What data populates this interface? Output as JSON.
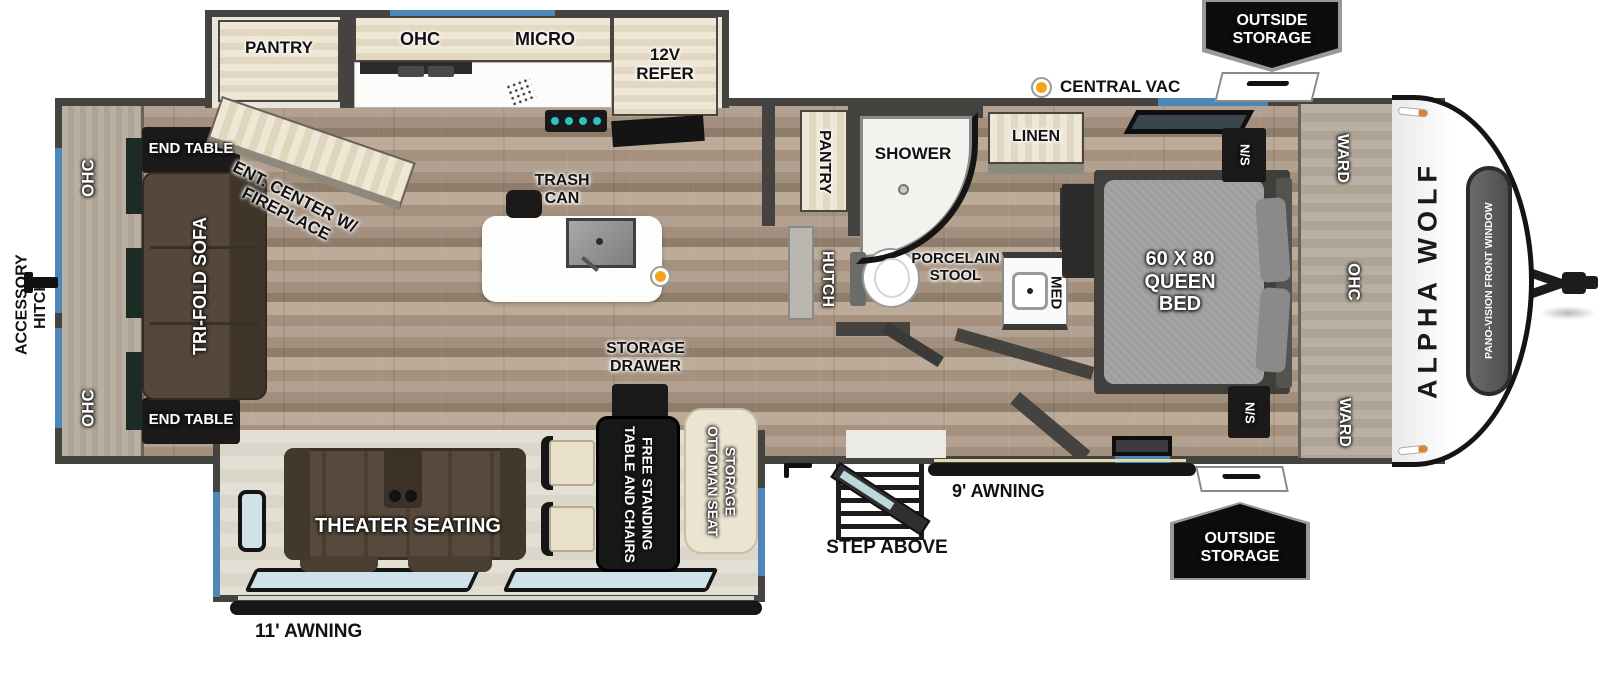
{
  "colors": {
    "wall": "#45433f",
    "accent_blue": "#4f86b8",
    "marker_orange": "#f2a51c",
    "badge_bg": "#0d0d0d",
    "window_glass": "#cfe2e8"
  },
  "brand": {
    "name": "ALPHA WOLF",
    "front_window": "PANO-VISION FRONT WINDOW"
  },
  "exterior": {
    "outside_storage_top": "OUTSIDE STORAGE",
    "outside_storage_bottom": "OUTSIDE STORAGE",
    "central_vac": "CENTRAL VAC",
    "accessory_hitch": "ACCESSORY HITCH",
    "awning_rear": "11' AWNING",
    "awning_door": "9' AWNING",
    "step_above": "STEP ABOVE"
  },
  "living": {
    "ohc_top": "OHC",
    "ohc_bottom": "OHC",
    "end_table_top": "END TABLE",
    "end_table_bottom": "END TABLE",
    "sofa": "TRI-FOLD SOFA",
    "ent_center": "ENT. CENTER W/ FIREPLACE",
    "theater": "THEATER SEATING",
    "dinette_table": "FREE STANDING TABLE AND CHAIRS",
    "ottoman": "STORAGE OTTOMAN SEAT"
  },
  "kitchen": {
    "pantry": "PANTRY",
    "ohc": "OHC",
    "micro": "MICRO",
    "refer": "12V REFER",
    "trash": "TRASH CAN",
    "storage_drawer": "STORAGE DRAWER"
  },
  "hall": {
    "pantry": "PANTRY",
    "hutch": "HUTCH"
  },
  "bath": {
    "shower": "SHOWER",
    "linen": "LINEN",
    "stool": "PORCELAIN STOOL",
    "med": "MED"
  },
  "bedroom": {
    "bed": "60 X 80 QUEEN BED",
    "ns_top": "N/S",
    "ns_bottom": "N/S",
    "ward_top": "WARD",
    "ward_bottom": "WARD",
    "ohc": "OHC"
  }
}
